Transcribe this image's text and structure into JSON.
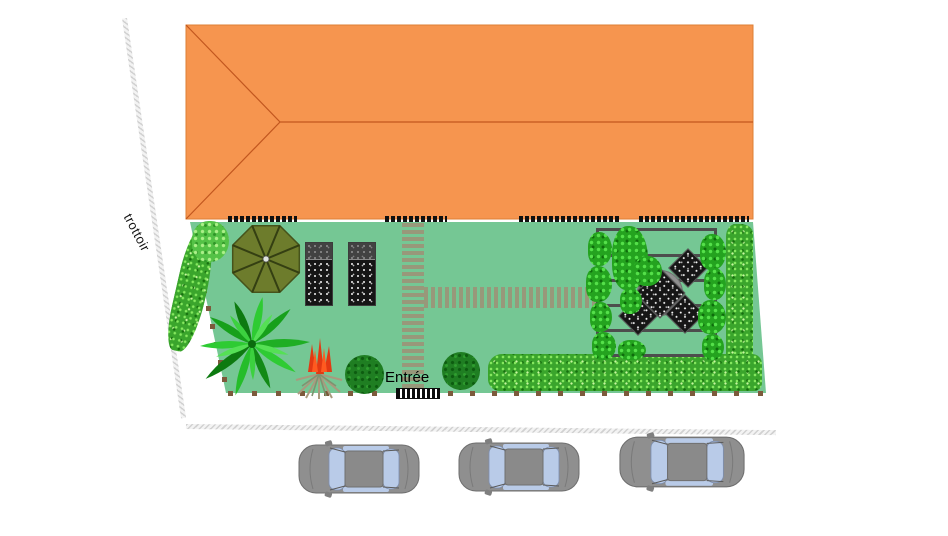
{
  "labels": {
    "sidewalk": "trottoir",
    "entrance": "Entrée"
  },
  "scene": {
    "house": {
      "description": "hipped orange roof seen from above",
      "roof_color": "#f6954f",
      "ridge_color": "#c2571f",
      "facade_openings": 4
    },
    "garden": {
      "lawn_color": "#75c794",
      "features": [
        {
          "name": "parasol",
          "color": "#6d7c2c"
        },
        {
          "name": "sun-lounger",
          "count": 2,
          "color": "#161616"
        },
        {
          "name": "small-tree"
        },
        {
          "name": "palm-tree"
        },
        {
          "name": "red-flower-plant"
        },
        {
          "name": "round-bush",
          "count": 2
        },
        {
          "name": "hedge-left"
        },
        {
          "name": "hedge-right"
        },
        {
          "name": "hedge-bottom"
        },
        {
          "name": "pergola-with-climbing-plants",
          "beams": 6
        },
        {
          "name": "garden-table",
          "chairs": 4
        },
        {
          "name": "duckboard-path-vertical"
        },
        {
          "name": "duckboard-path-horizontal"
        },
        {
          "name": "entrance-gate"
        },
        {
          "name": "fence-posts"
        }
      ]
    },
    "street": {
      "cars_parked": 3,
      "car_color": "#8f8f8f",
      "car_window_color": "#b9cbe8"
    }
  },
  "colors": {
    "lawn": "#75c794",
    "roof": "#f6954f",
    "hedge": "#3aa52c",
    "path": "#98987a",
    "pergola_beam": "#4d4d4d",
    "parasol": "#6d7c2c",
    "fence_post": "#7d5a3c",
    "sidewalk_hatch": "#c9c9c9"
  }
}
